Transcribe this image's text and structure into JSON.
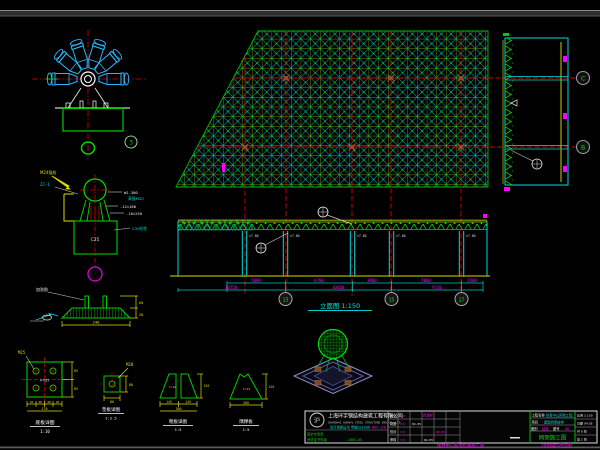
{
  "star_detail": {
    "bubble": "3"
  },
  "section_detail": {
    "axis_top": "C",
    "axis_bottom": "B"
  },
  "elevation": {
    "title": "立面图 1:150",
    "levels": [
      "▽7.80",
      "▽7.80",
      "▽7.80",
      "▽7.80",
      "▽7.80"
    ],
    "dims_upper": [
      "5800",
      "6700",
      "3900",
      "7000",
      "2100"
    ],
    "dims_lower": [
      "10750",
      "10600",
      "9150"
    ],
    "axes": [
      "13",
      "15",
      "17"
    ]
  },
  "support_detail": {
    "label_anchor": "M24锚栓",
    "label_left": "ZJ-1",
    "labels_right": [
      "WJ-300",
      "高强M20",
      "-12×180",
      "-10×250",
      "C30砼柱"
    ],
    "pedestal_text": "C25"
  },
  "plate_side": {
    "leader": "加劲肋",
    "dim_r1": "60",
    "dim_r2": "20",
    "dim_bottom": "240"
  },
  "plate_plan": {
    "center": "4-M25",
    "leader": "M25",
    "dim_r1": "85",
    "dim_r2": "85",
    "dims_bottom": [
      "45",
      "40",
      "40",
      "45"
    ],
    "dim_total": "170",
    "title": "底板详图",
    "scale": "1:10"
  },
  "pad_detail": {
    "leader": "M20",
    "dim_right": "80",
    "dim_bottom": "80",
    "title": "垫板详图",
    "scale": "1:2.5"
  },
  "gusset1": {
    "thk": "t=12",
    "d1": "145",
    "d2": "145",
    "total": "300",
    "h": "120",
    "title": "靴板详图",
    "scale": "1:5"
  },
  "gusset2": {
    "thk": "t=12",
    "d": "260",
    "h": "120",
    "title": "隅撑板",
    "scale": "1:5"
  },
  "title_block": {
    "logo_glyph": "沪",
    "company": "上海环宇钢结构建筑工程有限公司",
    "company_en": "SHANGHAI HUANYU STEEL STRUCTURE ENG.CO.,LTD",
    "cert": "设计资质证书 甲级021006",
    "cert_no": "№04-118",
    "stamp1": "审定专用章",
    "stamp2": "资质证书甲级",
    "stamp3": "2004.05",
    "sign_header": "会签栏",
    "rows": [
      {
        "label": "设计",
        "name": "××",
        "date": "04.05"
      },
      {
        "label": "制图",
        "name": "××",
        "date": "04.05"
      },
      {
        "label": "校对",
        "name": "××",
        "date": "04.05"
      },
      {
        "label": "审核",
        "name": "××",
        "date": "04.05"
      }
    ],
    "project_label": "工程名称",
    "project": "体育中心网架工程",
    "item_label": "项目",
    "item": "屋面网架结构",
    "cat_label": "图别",
    "cat": "结施",
    "no_label": "图号",
    "no": "08",
    "drawing_title": "网架施工图",
    "right_rows": [
      "比例 1:100",
      "日期 04.05",
      "共 8 张",
      "第 1 张"
    ],
    "footer_left": "体育中心网架结构施工图",
    "footer_right": "2004年5月出图"
  }
}
